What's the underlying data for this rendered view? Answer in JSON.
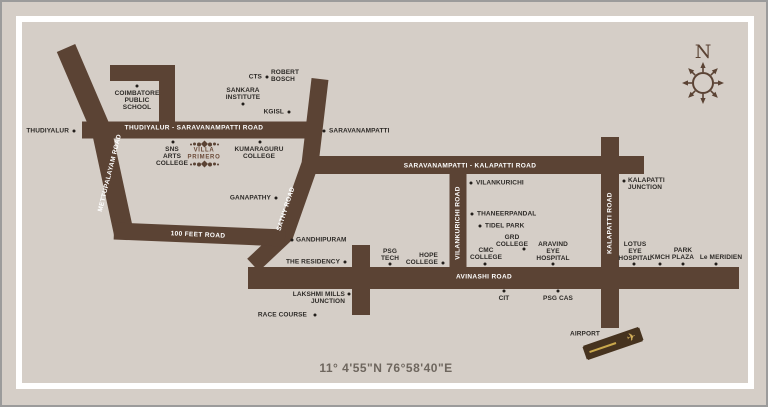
{
  "frame": {
    "compass_n": "N",
    "coordinates_text": "11° 4'55\"N 76°58'40\"E"
  },
  "logo": {
    "line1": "VILLA",
    "line2": "PRIMERO"
  },
  "road_labels": {
    "mettupalayam": "METTUPALAYAM ROAD",
    "thudiyalur_sarav": "THUDIYALUR - SARAVANAMPATTI ROAD",
    "sathy": "SATHY ROAD",
    "feet100": "100 FEET ROAD",
    "sarav_kalapatti": "SARAVANAMPATTI - KALAPATTI ROAD",
    "vilankurichi_road": "VILANKURICHI ROAD",
    "kalapatti_road": "KALAPATTI ROAD",
    "avinashi": "AVINASHI ROAD"
  },
  "places": {
    "thudiyalur": "THUDIYALUR",
    "coimbatore_public_school": "COIMBATORE\nPUBLIC\nSCHOOL",
    "cts": "CTS",
    "robert_bosch": "ROBERT\nBOSCH",
    "sankara_institute": "SANKARA\nINSTITUTE",
    "kgisl": "KGISL",
    "saravanampatti": "SARAVANAMPATTI",
    "sns_arts_college": "SNS\nARTS\nCOLLEGE",
    "kumaraguru_college": "KUMARAGURU\nCOLLEGE",
    "ganapathy": "GANAPATHY",
    "vilankurichi": "VILANKURICHI",
    "kalapatti_junction": "KALAPATTI\nJUNCTION",
    "gandhipuram": "GANDHIPURAM",
    "the_residency": "THE RESIDENCY",
    "psg_tech": "PSG\nTECH",
    "hope_college": "HOPE\nCOLLEGE",
    "cmc_college": "CMC\nCOLLEGE",
    "grd_college": "GRD\nCOLLEGE",
    "aravind_eye_hospital": "ARAVIND\nEYE\nHOSPITAL",
    "tidel_park": "TIDEL PARK",
    "thaneerpandal": "THANEERPANDAL",
    "lotus_eye_hospital": "LOTUS\nEYE\nHOSPITAL",
    "kmch": "KMCH",
    "park_plaza": "PARK\nPLAZA",
    "le_meridien": "Le MERIDIEN",
    "lakshmi_mills_junction": "LAKSHMI MILLS\nJUNCTION",
    "race_course": "RACE COURSE",
    "cit": "CIT",
    "psg_cas": "PSG CAS",
    "airport": "AIRPORT"
  },
  "icons": {
    "airplane": "✈"
  },
  "colors": {
    "background": "#d5cec7",
    "road": "#5b4334",
    "place_label": "#2d2a27",
    "road_label": "#ffffff",
    "runway": "#46331f",
    "runway_accent": "#c9a84c",
    "frame": "#ffffff",
    "outer_border": "#9b9b9b",
    "coordinates_text": "#6e665e"
  }
}
